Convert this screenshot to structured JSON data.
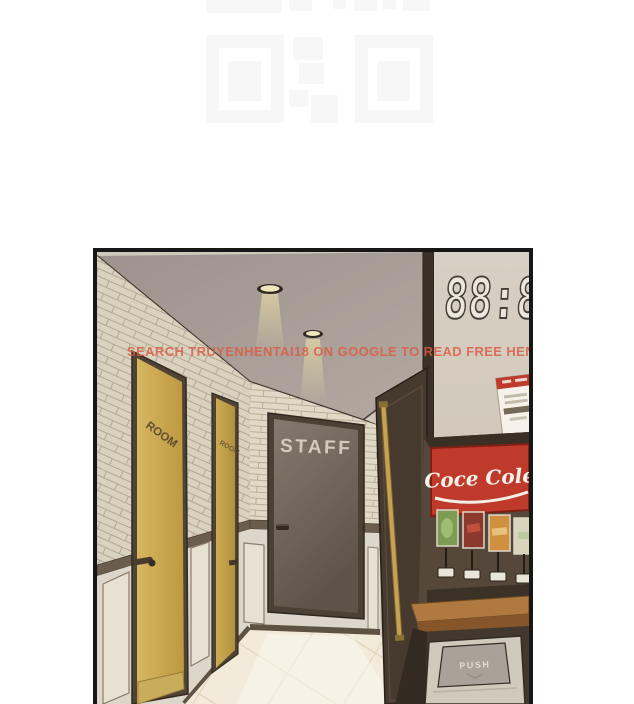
{
  "background_pattern": {
    "name": "faint-qr-placeholder",
    "color": "#f7f7f7"
  },
  "watermark": {
    "text": "SEARCH TRUYENHENTAI18 ON GOOGLE TO READ FREE HENTAI",
    "color": "#dc5a42"
  },
  "panel": {
    "scene": "hotel-corridor",
    "clock": {
      "display": "88:8",
      "style": "seven-segment-outline"
    },
    "doors": [
      {
        "id": "room-door-1",
        "label": "ROOM",
        "color": "#c9a84e"
      },
      {
        "id": "room-door-2",
        "label": "ROOM",
        "color": "#c2a148"
      },
      {
        "id": "staff-door",
        "label": "STAFF",
        "color": "#6e6358"
      }
    ],
    "side_door_color": "#463a2e",
    "vending_machine": {
      "brand": "Coce Cole",
      "sign_color": "#c03a2b",
      "flavor_cards": [
        "green",
        "red",
        "orange",
        "cream"
      ]
    },
    "trash_bin": {
      "flap_label": "PUSH"
    }
  }
}
